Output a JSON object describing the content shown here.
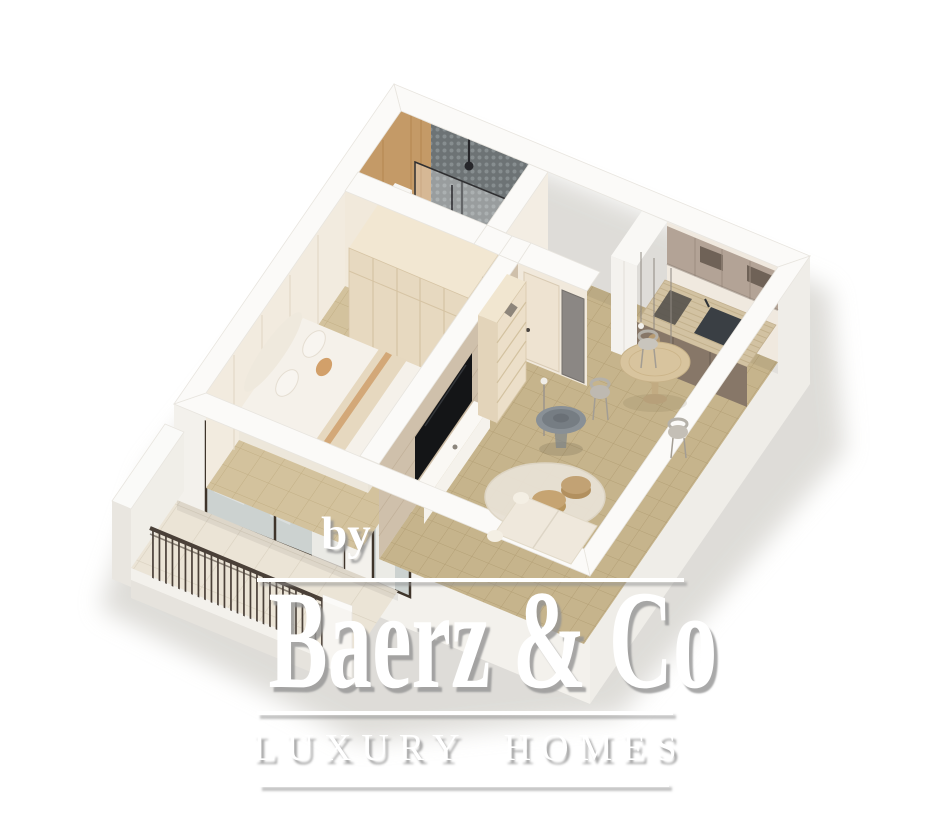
{
  "watermark": {
    "prefix": "by",
    "brand": "Baerz & Co",
    "tagline": "LUXURY HOMES"
  },
  "palette": {
    "background": "#ffffff",
    "wall_top": "#fbfaf8",
    "wall_exterior": "#efede8",
    "wall_interior_cream": "#f1e9dc",
    "floor_living": "#c6b48c",
    "floor_bedroom": "#d3c29d",
    "floor_balcony": "#ebe4d6",
    "floor_bathroom": "#e9e7e3",
    "floor_hallway": "#efe9e0",
    "wood_accent": "#c49a67",
    "mosaic_tile": "#6d7375",
    "wardrobe": "#e7d9c0",
    "kitchen_cabinet": "#877768",
    "kitchen_upper": "#b3a396",
    "countertop": "#d2c2a2",
    "dining_table": "#d8c49e",
    "rug": "#e8e1d4",
    "pouf": "#c2a274",
    "tv_screen": "#17181a",
    "railing": "#4a4038",
    "bedding": "#f5f1ea",
    "accent_textile": "#d2a06a",
    "shadow": "#d5d3ce"
  }
}
